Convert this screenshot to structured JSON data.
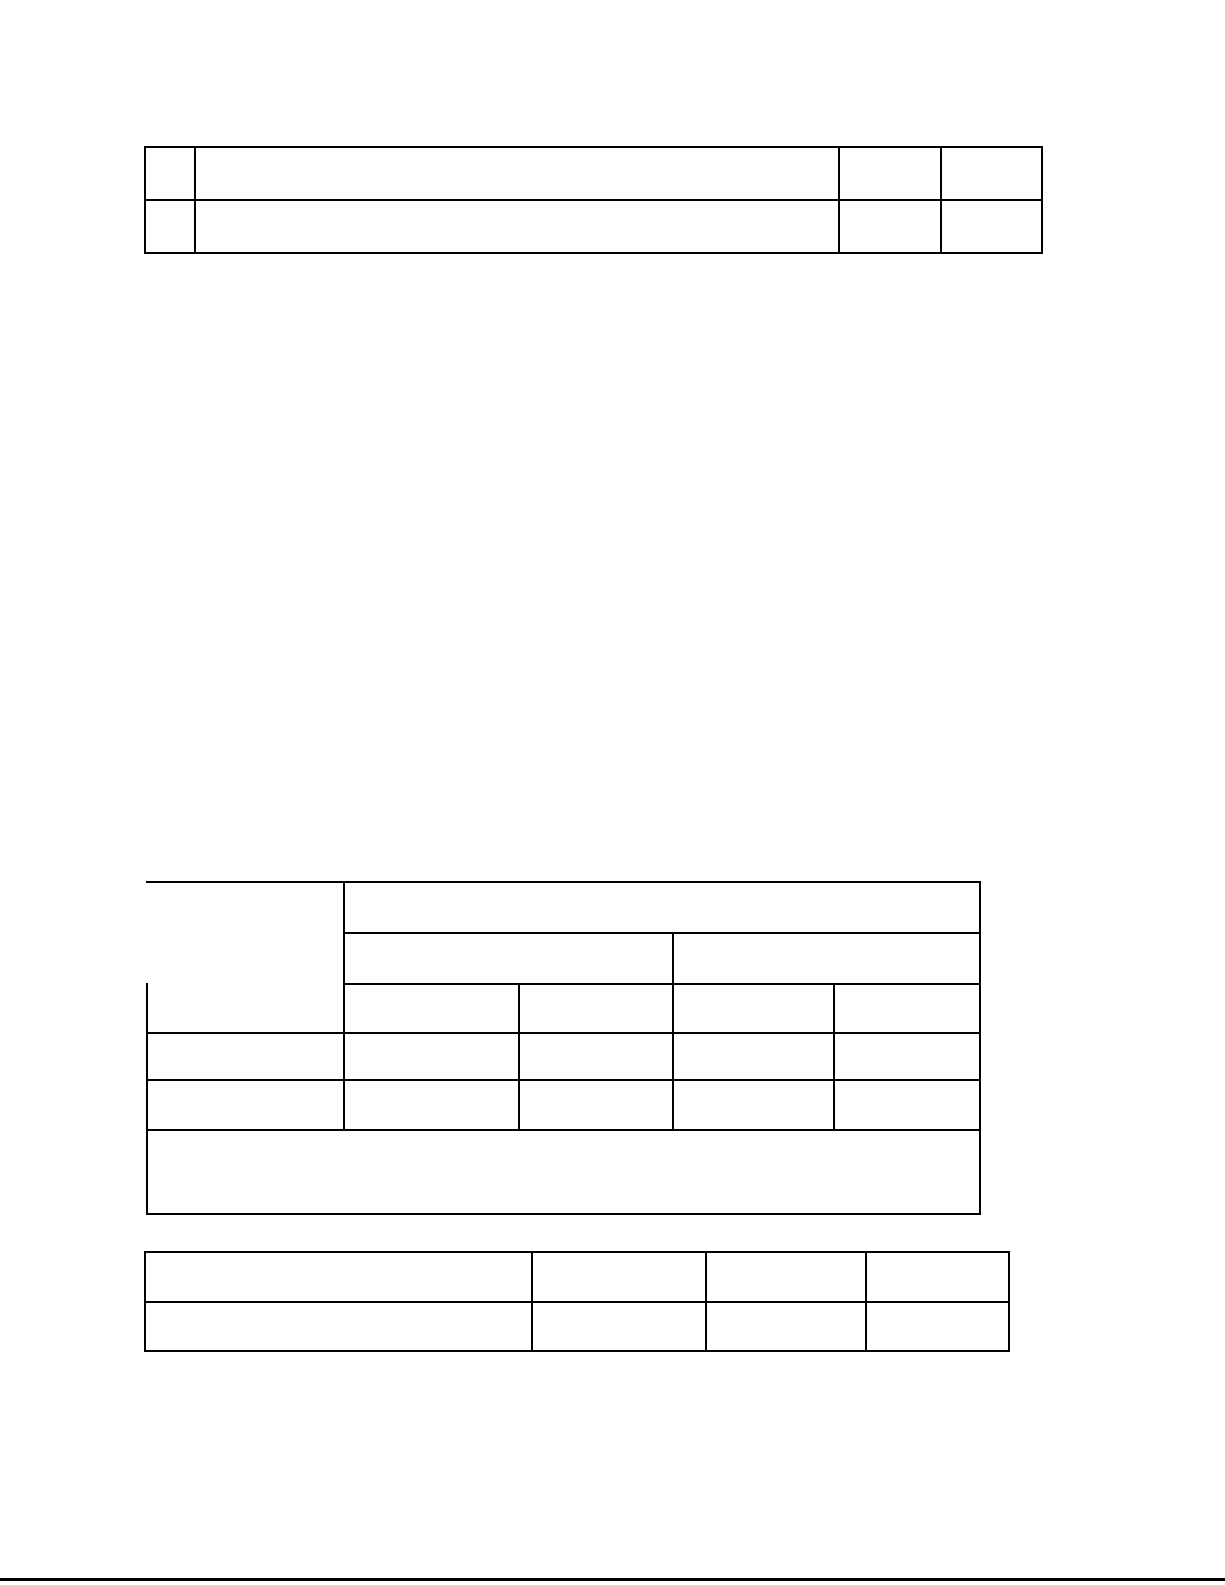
{
  "page": {
    "background_color": "#ffffff",
    "line_color": "#000000"
  },
  "top_table": {
    "rows": [
      [
        "",
        "",
        "",
        ""
      ],
      [
        "",
        "",
        "",
        ""
      ]
    ]
  },
  "middle_table": {
    "corner_cell": "",
    "span_header_cell": "",
    "group_header_cells": [
      "",
      ""
    ],
    "column_header_cells": [
      "",
      "",
      "",
      ""
    ],
    "data_rows": [
      [
        "",
        "",
        "",
        "",
        ""
      ],
      [
        "",
        "",
        "",
        "",
        ""
      ]
    ],
    "footer_cell": ""
  },
  "bottom_table": {
    "rows": [
      [
        "",
        "",
        "",
        ""
      ],
      [
        "",
        "",
        "",
        ""
      ]
    ]
  },
  "footer_rule": {
    "color": "#000000"
  }
}
